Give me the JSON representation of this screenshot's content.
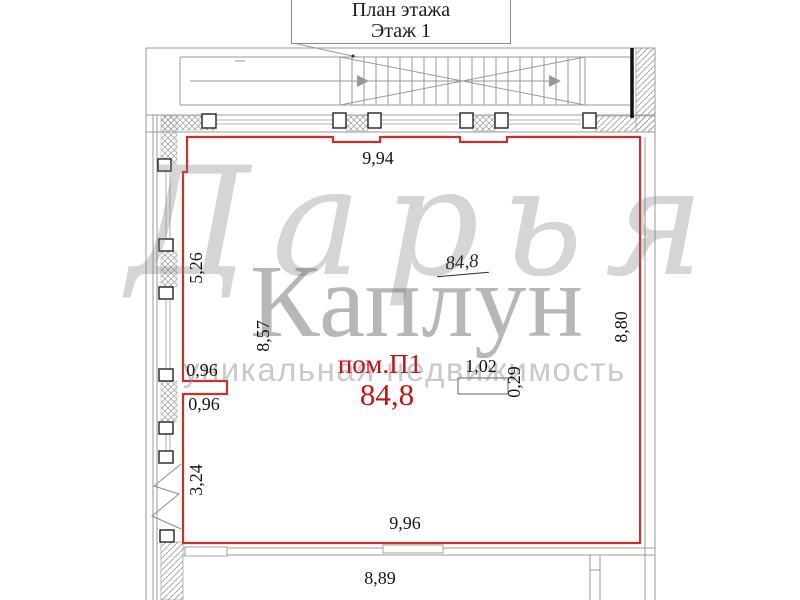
{
  "title": {
    "line1": "План этажа",
    "line2": "Этаж 1"
  },
  "room": {
    "label": "пом.П1",
    "area": "84,8",
    "area_note": "84,8"
  },
  "dimensions": {
    "top": "9,94",
    "left_upper": "5,26",
    "left_mid": "8,57",
    "notch_top": "0,96",
    "notch_bottom": "0,96",
    "left_lower": "3,24",
    "column_width": "1,02",
    "column_depth": "0,29",
    "right": "8,80",
    "bottom": "9,96",
    "bottom_outer": "8,89"
  },
  "watermark": {
    "script": "Дарья",
    "name": "Каплун",
    "tagline": "уникальная недвижимость"
  },
  "colors": {
    "outline_red": "#c9302c",
    "label_red": "#c41414",
    "line_gray": "#9a9a9a",
    "ink": "#1a1a1a",
    "watermark_gray": "#8a8a8a"
  }
}
